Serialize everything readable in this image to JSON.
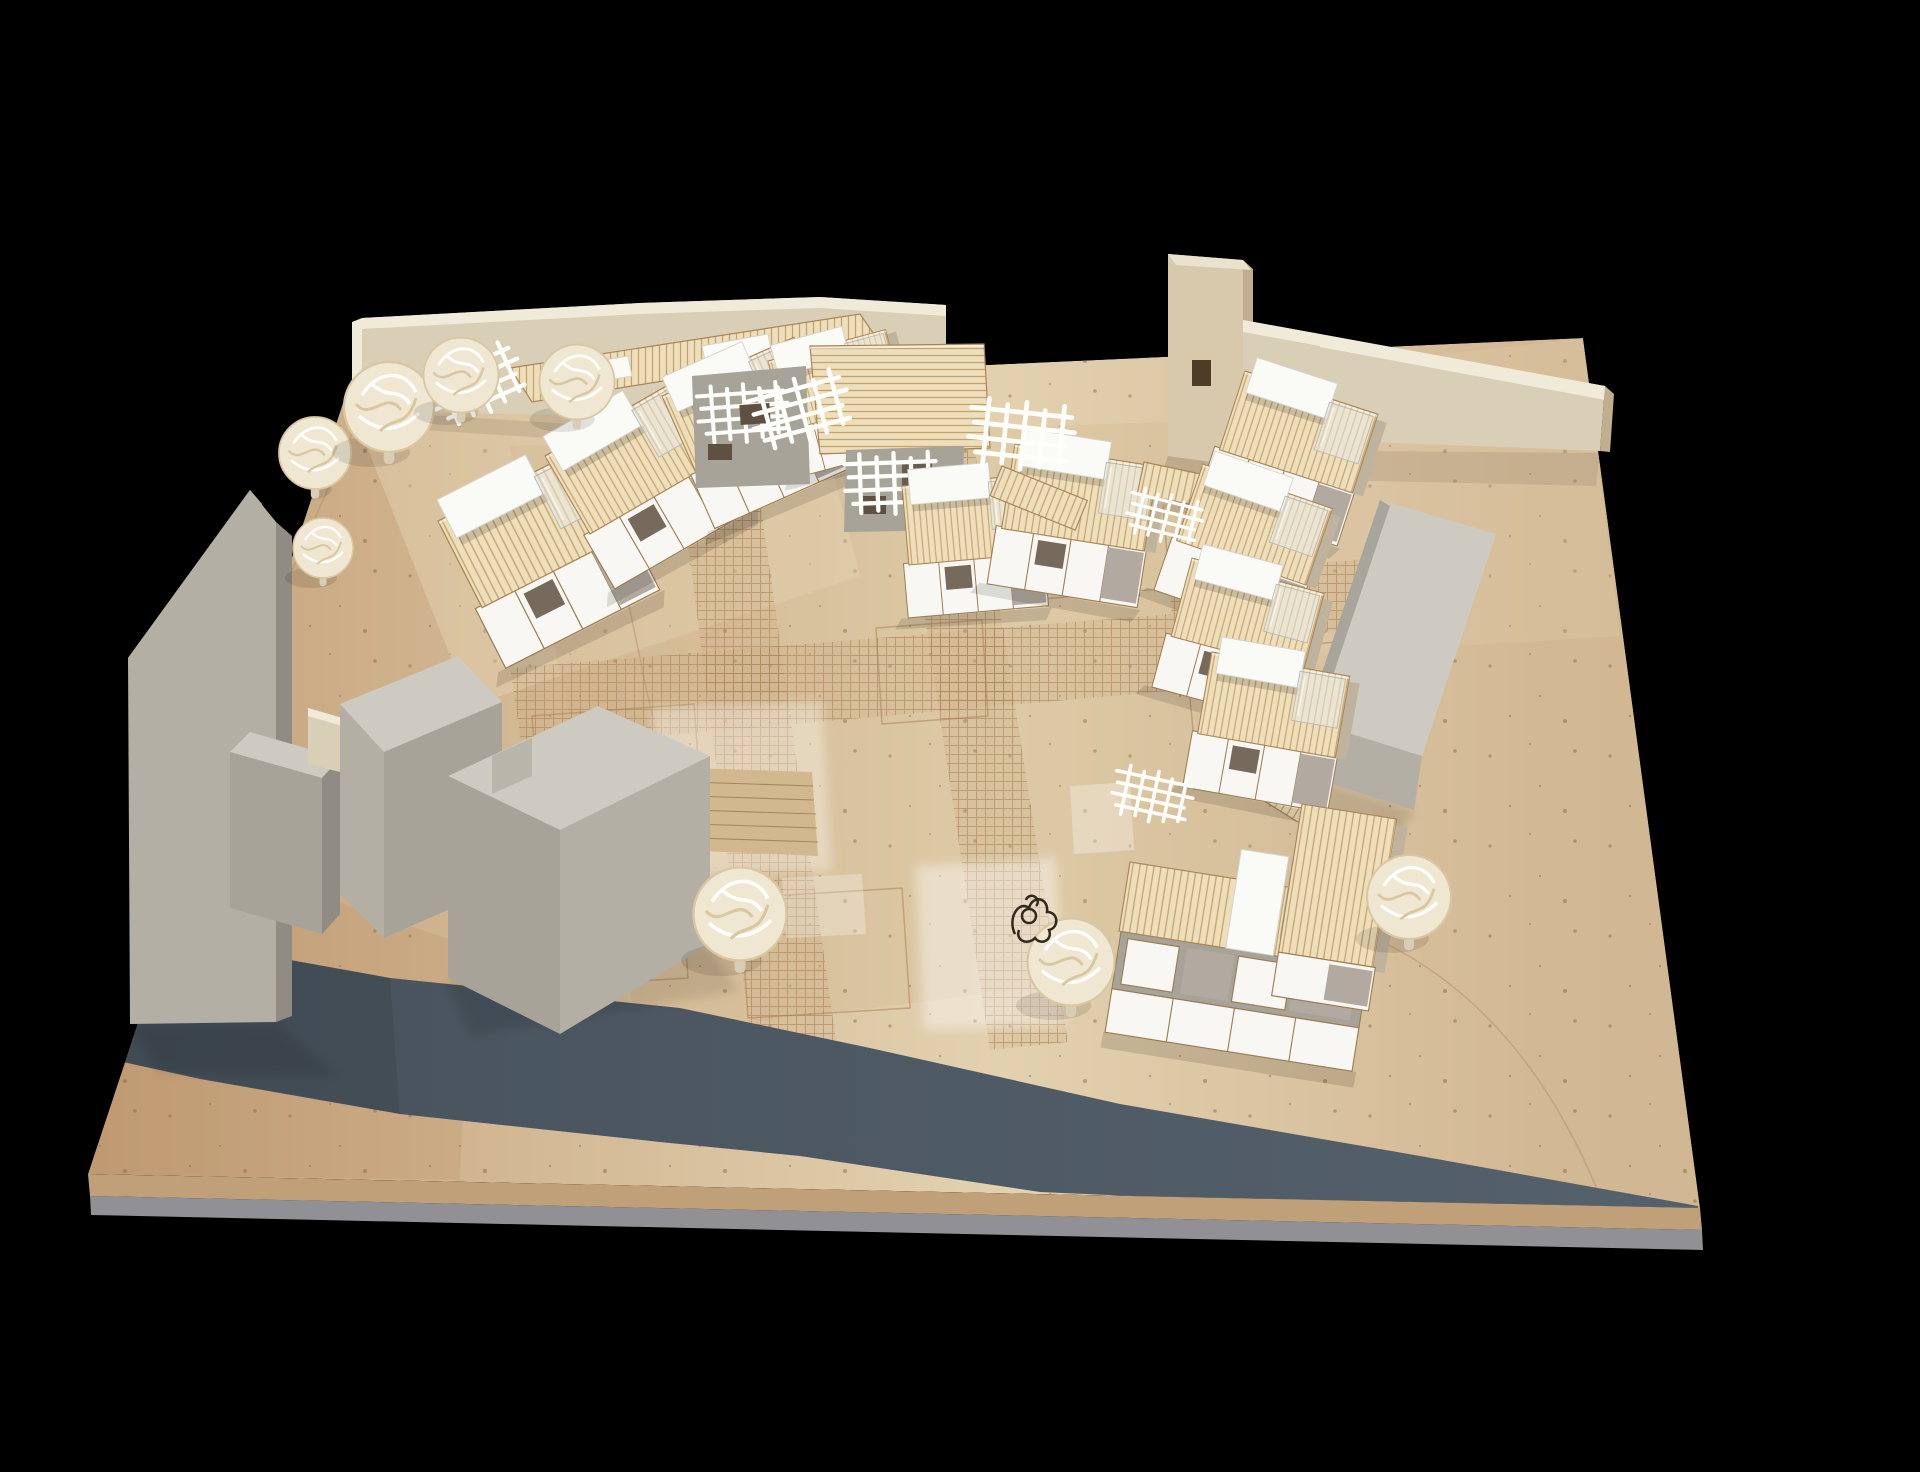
{
  "meta": {
    "caption": "Photograph of a cardboard and balsa architectural site model on a black background: a cluster of timber row houses with white roof caps around etched courtyards, gray context building blocks, a perimeter wall with a stair tower, wood-wool trees and a dark slate road across the tan baseboard."
  },
  "palette": {
    "bg": "#000000",
    "board_l": "#c29c74",
    "board_m": "#d3b894",
    "board_m2": "#e2d1af",
    "board_r": "#cdb490",
    "board_light_overlay": "#eee0bf",
    "board_dark_overlay": "#a87c50",
    "speck": "#7d5f3f",
    "edge_tan": "#bfa078",
    "edge_gray": "#909095",
    "road_a": "#46515b",
    "road_b": "#57636e",
    "wall_cream": "#d9ceb6",
    "wall_top": "#f0ead9",
    "tower_front": "#d8c9ac",
    "tower_side": "#c1ae8f",
    "tower_top": "#eae2cd",
    "tower_window": "#4f3b27",
    "gray_light": "#cdcac2",
    "gray_mid": "#b3afa5",
    "gray_mid2": "#a7a399",
    "gray_dark": "#908c83",
    "roof_base": "#eddfbc",
    "roof_line": "#c8a26c",
    "roof_edge": "#a8865a",
    "facade_white": "#f8f7f3",
    "facade_taupe": "#b2aaa0",
    "facade_frame": "#9b7a4f",
    "side_tan": "#c0b39d",
    "cap_white": "#fafaf7",
    "cap_edge": "#d6d3ca",
    "acrylic": "#e7e9e7",
    "acrylic_edge": "#b6bab6",
    "trellis": "#fdfdfa",
    "opening": "#5f5142",
    "tree_fill": "#efe7d1",
    "tree_line": "#ffffff",
    "tree_line2": "#d9c7a2",
    "trunk": "#d8cdb7",
    "paving_line": "#a87c50",
    "paving_bg": "#c9a87e",
    "patch_white": "#ffffff",
    "wire": "#32291e",
    "stair_face": "#d2b88f"
  },
  "scene": {
    "inventory": {
      "timber_houses": 12,
      "context_buildings_gray": 6,
      "stair_tower": 1,
      "perimeter_wall_sections": 3,
      "trees_woodwool": 8,
      "wire_tree_sculpture": 1,
      "pergola_trellises": 5,
      "road": 1,
      "plaza_stairs": 1
    }
  }
}
